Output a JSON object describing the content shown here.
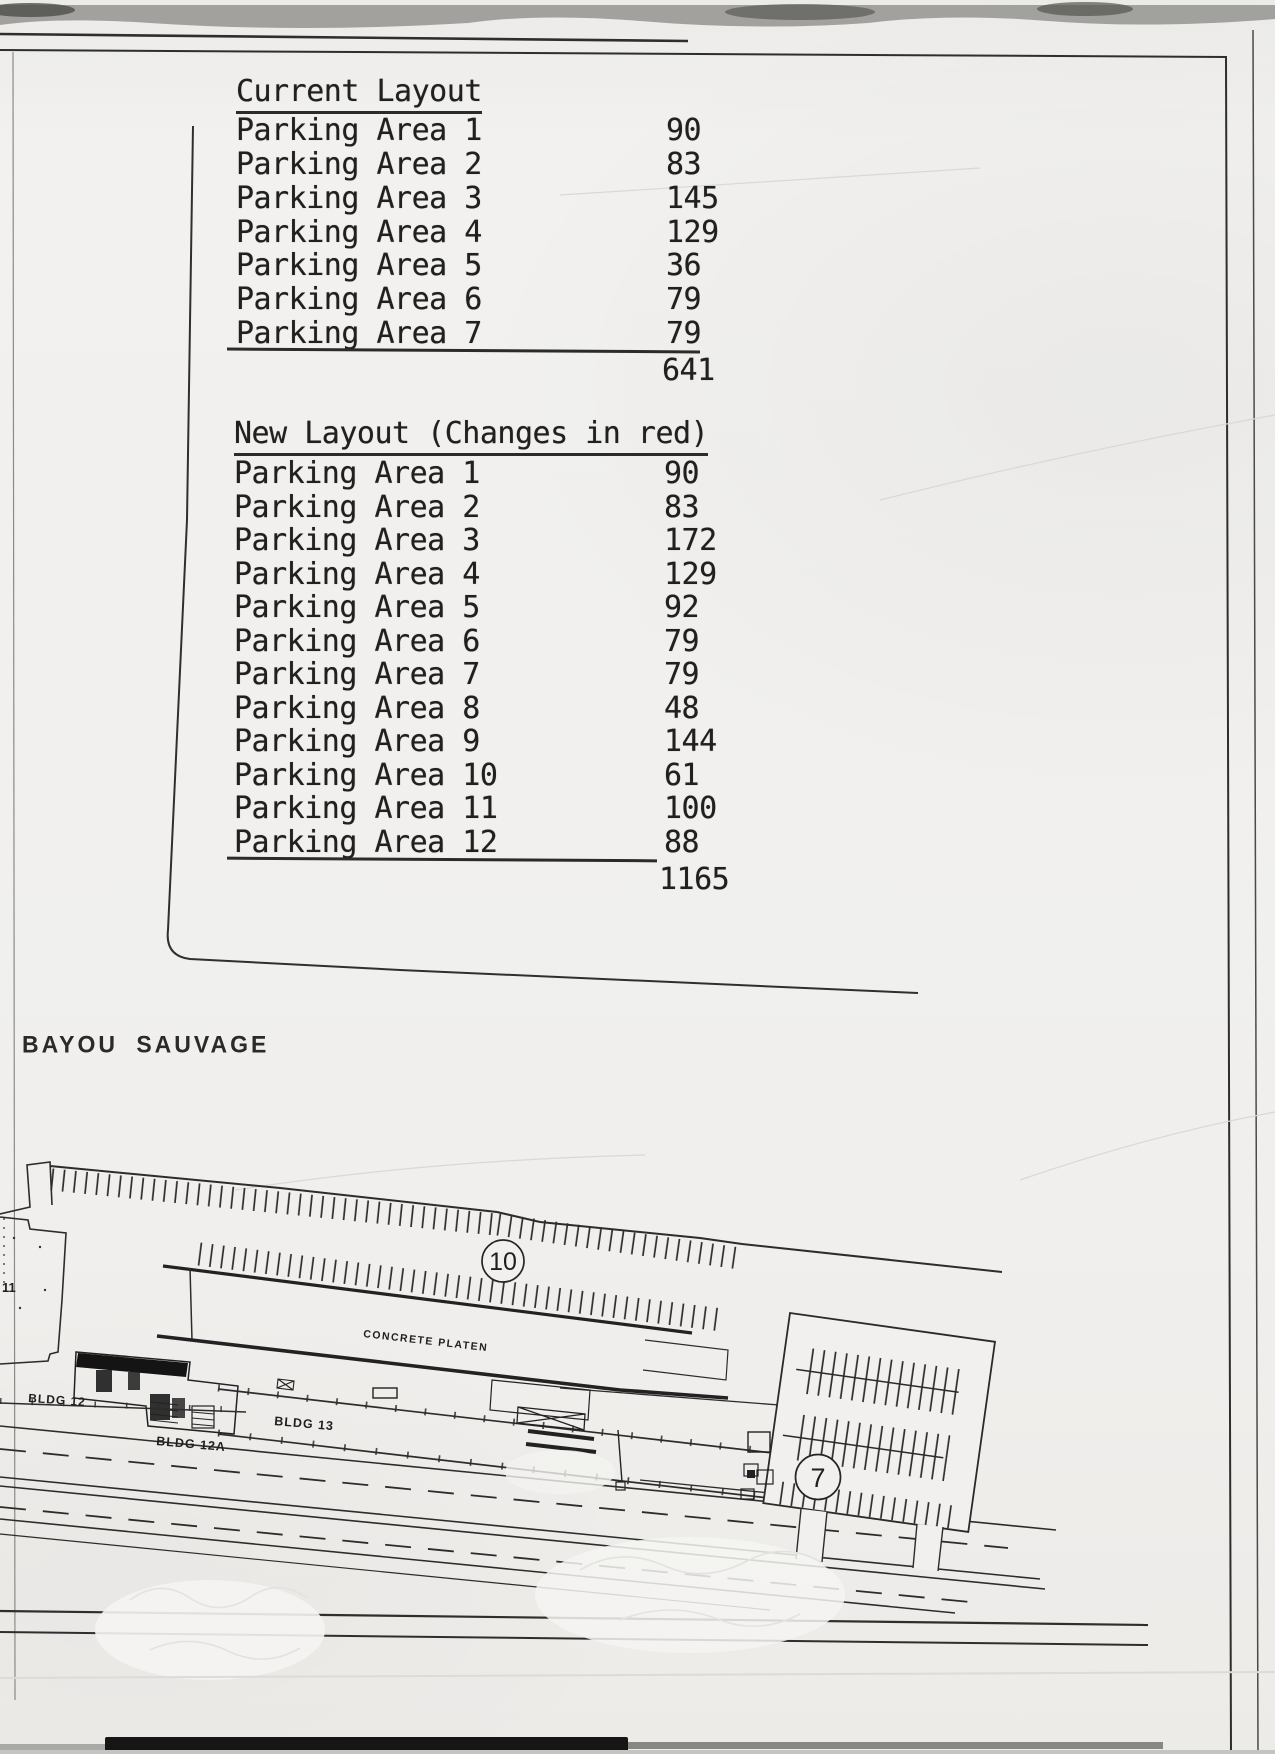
{
  "tables": {
    "current": {
      "title": "Current Layout",
      "rows": [
        {
          "label": "Parking Area 1",
          "value": "90"
        },
        {
          "label": "Parking Area 2",
          "value": "83"
        },
        {
          "label": "Parking Area 3",
          "value": "145"
        },
        {
          "label": "Parking Area 4",
          "value": "129"
        },
        {
          "label": "Parking Area 5",
          "value": "36"
        },
        {
          "label": "Parking Area 6",
          "value": "79"
        },
        {
          "label": "Parking Area 7",
          "value": "79"
        }
      ],
      "total": "641"
    },
    "new": {
      "title": "New Layout (Changes in red)",
      "rows": [
        {
          "label": "Parking Area 1",
          "value": "90"
        },
        {
          "label": "Parking Area 2",
          "value": "83"
        },
        {
          "label": "Parking Area 3",
          "value": "172"
        },
        {
          "label": "Parking Area 4",
          "value": "129"
        },
        {
          "label": "Parking Area 5",
          "value": "92"
        },
        {
          "label": "Parking Area 6",
          "value": "79"
        },
        {
          "label": "Parking Area 7",
          "value": "79"
        },
        {
          "label": "Parking Area 8",
          "value": "48"
        },
        {
          "label": "Parking Area 9",
          "value": "144"
        },
        {
          "label": "Parking Area 10",
          "value": "61"
        },
        {
          "label": "Parking Area 11",
          "value": "100"
        },
        {
          "label": "Parking Area 12",
          "value": "88"
        }
      ],
      "total": "1165"
    }
  },
  "site_plan": {
    "region_label": "BAYOU SAUVAGE",
    "concrete_platen_label": "CONCRETE PLATEN",
    "bldg12_label": "BLDG 12",
    "bldg12a_label": "BLDG 12A",
    "bldg13_label": "BLDG 13",
    "area10_label": "10",
    "area7_label": "7",
    "area11_partial_label": "11"
  },
  "colors": {
    "paper": "#f1f0ee",
    "ink": "#2a2a2a",
    "scan_band": "#8e8e8a"
  }
}
